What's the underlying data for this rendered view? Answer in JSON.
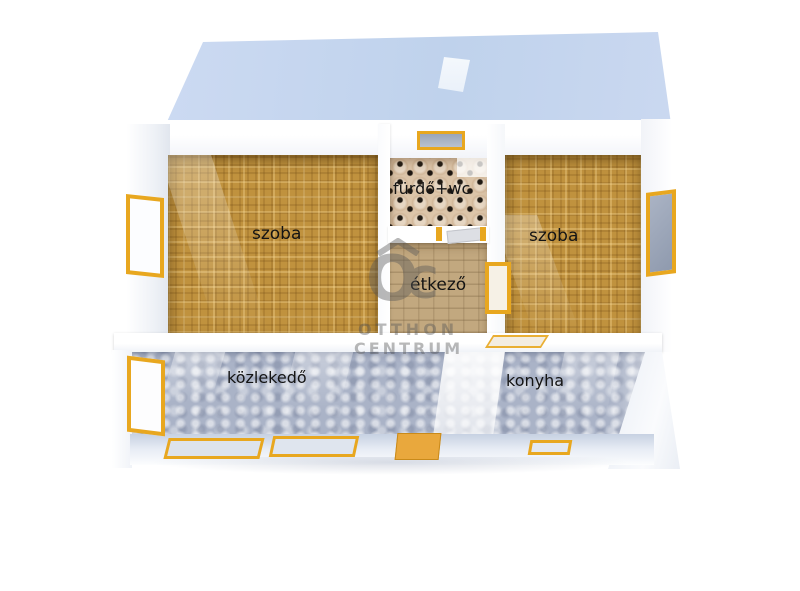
{
  "rooms": [
    {
      "id": "room-left",
      "label": "szoba"
    },
    {
      "id": "bathroom",
      "label": "fürdő+wc"
    },
    {
      "id": "dining",
      "label": "étkező"
    },
    {
      "id": "room-right",
      "label": "szoba"
    },
    {
      "id": "hallway",
      "label": "közlekedő"
    },
    {
      "id": "kitchen",
      "label": "konyha"
    }
  ],
  "watermark": {
    "logo_letter_o": "O",
    "logo_letter_c": "C",
    "name_line1": "OTTHON",
    "name_line2": "CENTRUM",
    "roof_icon": "house-roof-icon"
  },
  "colors": {
    "roof_blue": "#c5d5ee",
    "carpet_tan": "#c0923e",
    "bath_tile_beige": "#dcc5a9",
    "dining_tile_brown": "#c2a87f",
    "hall_floor_bluegray": "#aab3c7",
    "frame_yellow": "#e8a71f",
    "door_orange": "#e9a83d",
    "glass_gray": "#98a3b6",
    "label_black": "#141414",
    "watermark_gray": "#595959"
  }
}
